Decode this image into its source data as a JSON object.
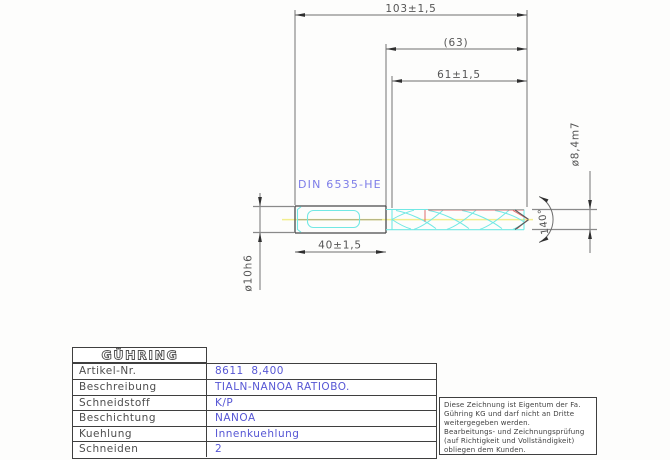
{
  "drawing": {
    "dimensions": {
      "overall_length": "103±1,5",
      "reference_length": "(63)",
      "flute_length": "61±1,5",
      "clamping_length": "40±1,5",
      "shank_diameter": "ø10h6",
      "cutting_diameter": "ø8,4m7",
      "point_angle": "140°"
    },
    "labels": {
      "shank_standard": "DIN 6535-HE"
    },
    "colors": {
      "outline_gray": "#4a4a4a",
      "dimension_gray": "#6e6e6e",
      "highlight_cyan": "#72e8e4",
      "highlight_red": "#e06c6c",
      "centerline_yellow": "#f2ee8e",
      "annotation_blue": "#7d7de8",
      "value_blue": "#5656d4"
    }
  },
  "title_block": {
    "logo_text": "GÜHRING",
    "rows": [
      {
        "label": "Artikel-Nr.",
        "value": "8611  8,400"
      },
      {
        "label": "Beschreibung",
        "value": "TIALN-NANOA RATIOBO."
      },
      {
        "label": "Schneidstoff",
        "value": "K/P"
      },
      {
        "label": "Beschichtung",
        "value": "NANOA"
      },
      {
        "label": "Kuehlung",
        "value": "Innenkuehlung"
      },
      {
        "label": "Schneiden",
        "value": "2"
      }
    ]
  },
  "disclaimer": {
    "lines": [
      "Diese Zeichnung ist Eigentum der Fa.",
      "Gühring KG und darf nicht an Dritte",
      "weitergegeben werden.",
      "Bearbeitungs- und Zeichnungsprüfung",
      "(auf Richtigkeit und Vollständigkeit)",
      "obliegen dem Kunden."
    ]
  }
}
